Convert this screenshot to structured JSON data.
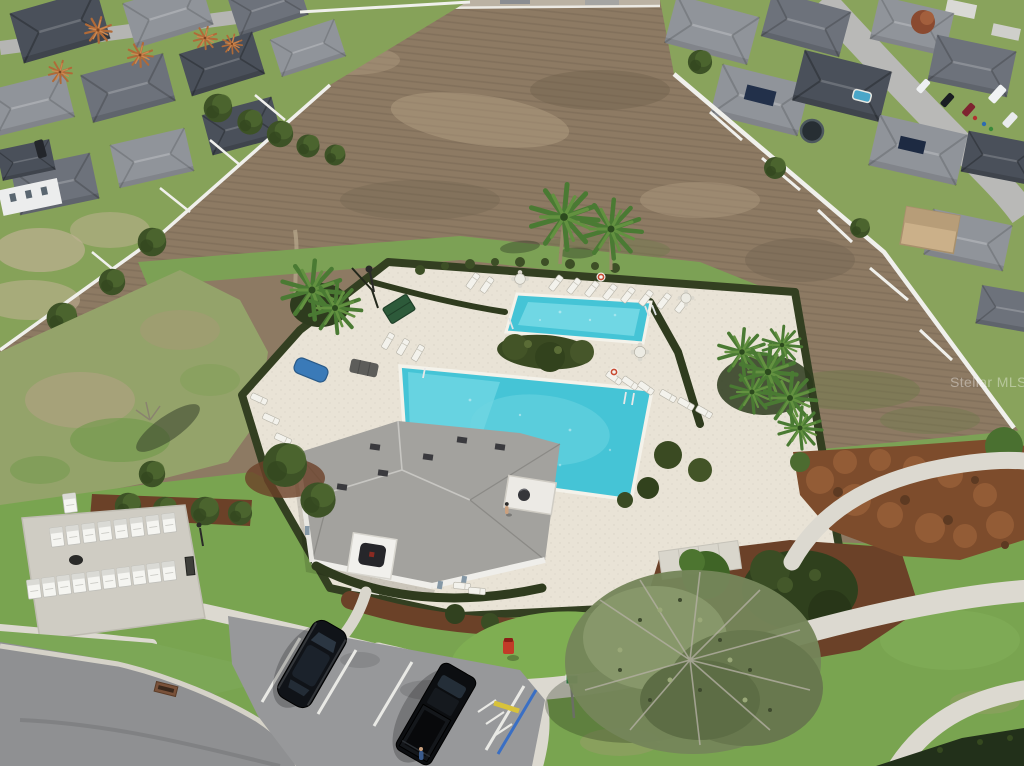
{
  "image": {
    "kind": "aerial-drone-photograph",
    "subject": "Residential community amenity center with two swimming pools, clubhouse, lounge chairs, cluster mailboxes, parking lot and curved walkways, bordered by a plowed dirt field and suburban single-family homes",
    "width": 1024,
    "height": 766
  },
  "watermark": {
    "text": "Stellar MLS",
    "color": "#ffffff",
    "opacity": 0.38
  },
  "scene": {
    "palette": {
      "field": "#8d7a63",
      "grass": "#7ca155",
      "grass_bright": "#7fae52",
      "lawn": "#79a450",
      "rough_grass": "#94a36a",
      "deck": "#e9e3d6",
      "hedge": "#333f21",
      "pool_water": "#45c4d6",
      "pool_water_light": "#7fdde8",
      "coping": "#f4f2ea",
      "sidewalk": "#dcd9d0",
      "asphalt": "#97989a",
      "road": "#8f9092",
      "mulch": "#6b4128",
      "rust_shrub": "#7d4c2c",
      "roof": "#a3a29e",
      "wall_white": "#efeeea",
      "tree_dark": "#3d5226",
      "tree_sage": "#75855a",
      "fence_white": "#f0f0ec",
      "car_dark": "#101318",
      "hydrant_red": "#c23b28",
      "canopy_green": "#2d5a3a",
      "tarp_blue": "#3a7ab8",
      "accessible_blue": "#3a6fc4",
      "curb_yellow": "#d8c23a"
    },
    "labels": {
      "field": "plowed dirt field",
      "left_neighborhood": "single-family homes (left)",
      "right_neighborhood": "single-family homes with solar panels (right)",
      "amenity": "community pool amenity center",
      "main_pool": "main swimming pool",
      "upper_pool": "secondary swimming pool",
      "clubhouse": "clubhouse with gray shingle roof",
      "mailboxes": "cluster mailbox kiosks",
      "parking": "parking lot with accessible space",
      "big_tree": "large spreading tree",
      "palms": "palm trees",
      "walkways": "curved concrete walkways"
    },
    "counts": {
      "pools": 2,
      "tall_palms": 2,
      "lounge_chairs": 27,
      "table_sets": 4,
      "mailbox_units": 19,
      "people": 2,
      "foreground_vehicles": 2,
      "street_vehicles": 5
    }
  }
}
